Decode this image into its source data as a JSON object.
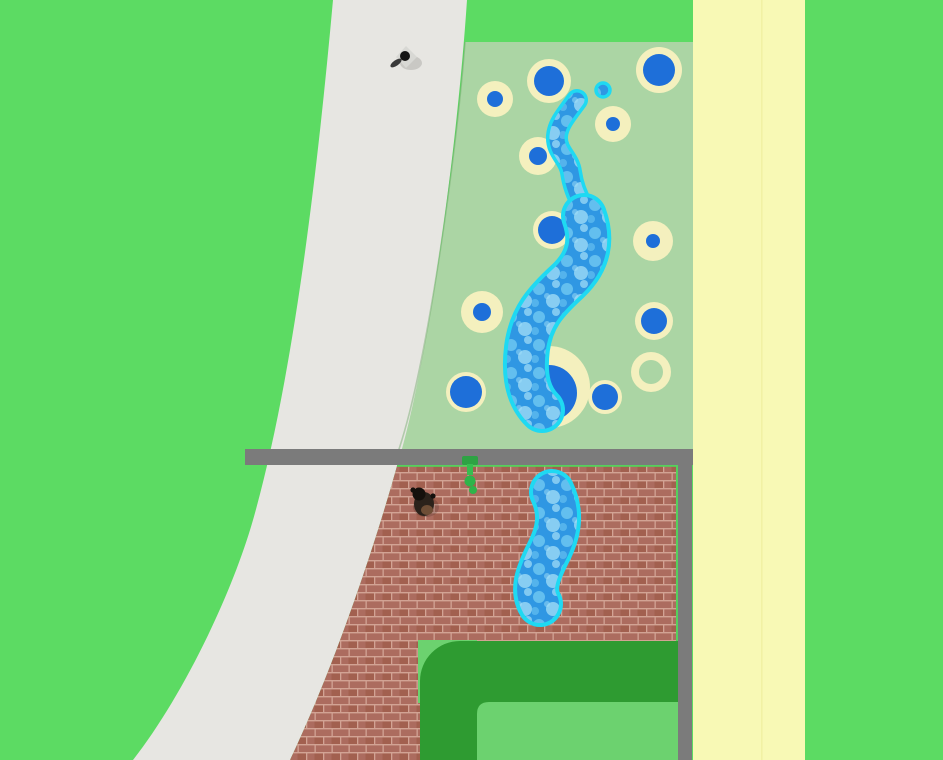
{
  "scene": {
    "type": "top-down-game-view",
    "description": "Aerial builder-game view of a water park: pastel-green pool deck with round pools and winding blue water slides, a curved white walkway, a walled brick yard with a splash pool, a dark green go-kart style track corner, and a pale yellow road strip.",
    "visible_text": ""
  },
  "colors": {
    "grass": "#5CDB63",
    "walkway": "#E7E6E2",
    "panel_green": "#ABD5A4",
    "pool_ring_cream": "#F4F0BE",
    "pool_blue": "#1E6FD9",
    "slide_border": "#1FD9F2",
    "water_base": "#2F97E3",
    "water_mid": "#6CC6F1",
    "water_light": "#A4DFF7",
    "yellow_road": "#F8F9B5",
    "yellow_road_seam": "#EFEFA0",
    "wall_gray": "#7B7B7B",
    "brick": "#AC6C5F",
    "brick_dark": "#A2604f",
    "brick_mortar": "#D2A394",
    "brick_seam_green": "#55D05C",
    "course_dark_green": "#2E9B31",
    "course_light_green": "#6CD26F",
    "panel_edge_shadow": "#6FA868",
    "person_body": "#D8D8D4",
    "person_head": "#141414",
    "person_arm": "#3A3A3A",
    "dog_body": "#2B221B",
    "dog_head": "#15100C",
    "dog_patch": "#6E4E36",
    "figure_green_dark": "#2EA344",
    "figure_green": "#37BE50",
    "figure_green_blob": "#2FB44A"
  },
  "pools": [
    {
      "cx": 495,
      "cy": 99,
      "ring": 18,
      "blue": 8
    },
    {
      "cx": 549,
      "cy": 81,
      "ring": 22,
      "blue": 15
    },
    {
      "cx": 659,
      "cy": 70,
      "ring": 23,
      "blue": 16
    },
    {
      "cx": 613,
      "cy": 124,
      "ring": 18,
      "blue": 7
    },
    {
      "cx": 538,
      "cy": 156,
      "ring": 19,
      "blue": 9
    },
    {
      "cx": 552,
      "cy": 230,
      "ring": 19,
      "blue": 14
    },
    {
      "cx": 653,
      "cy": 241,
      "ring": 20,
      "blue": 7
    },
    {
      "cx": 482,
      "cy": 312,
      "ring": 21,
      "blue": 9
    },
    {
      "cx": 654,
      "cy": 321,
      "ring": 19,
      "blue": 13
    },
    {
      "cx": 651,
      "cy": 372,
      "ring": 20,
      "blue": 0,
      "empty": true,
      "inner": 12
    },
    {
      "cx": 466,
      "cy": 392,
      "ring": 20,
      "blue": 16
    },
    {
      "cx": 549,
      "cy": 387,
      "ring": 41,
      "blue": 28,
      "blue_dy": 6
    },
    {
      "cx": 605,
      "cy": 397,
      "ring": 17,
      "blue": 13
    }
  ],
  "mini_pool": {
    "cx": 603,
    "cy": 90,
    "r": 7
  },
  "characters": {
    "person": {
      "x": 406,
      "y": 57
    },
    "dog": {
      "x": 424,
      "y": 503
    },
    "green_figure": {
      "x": 470,
      "y": 470
    }
  }
}
